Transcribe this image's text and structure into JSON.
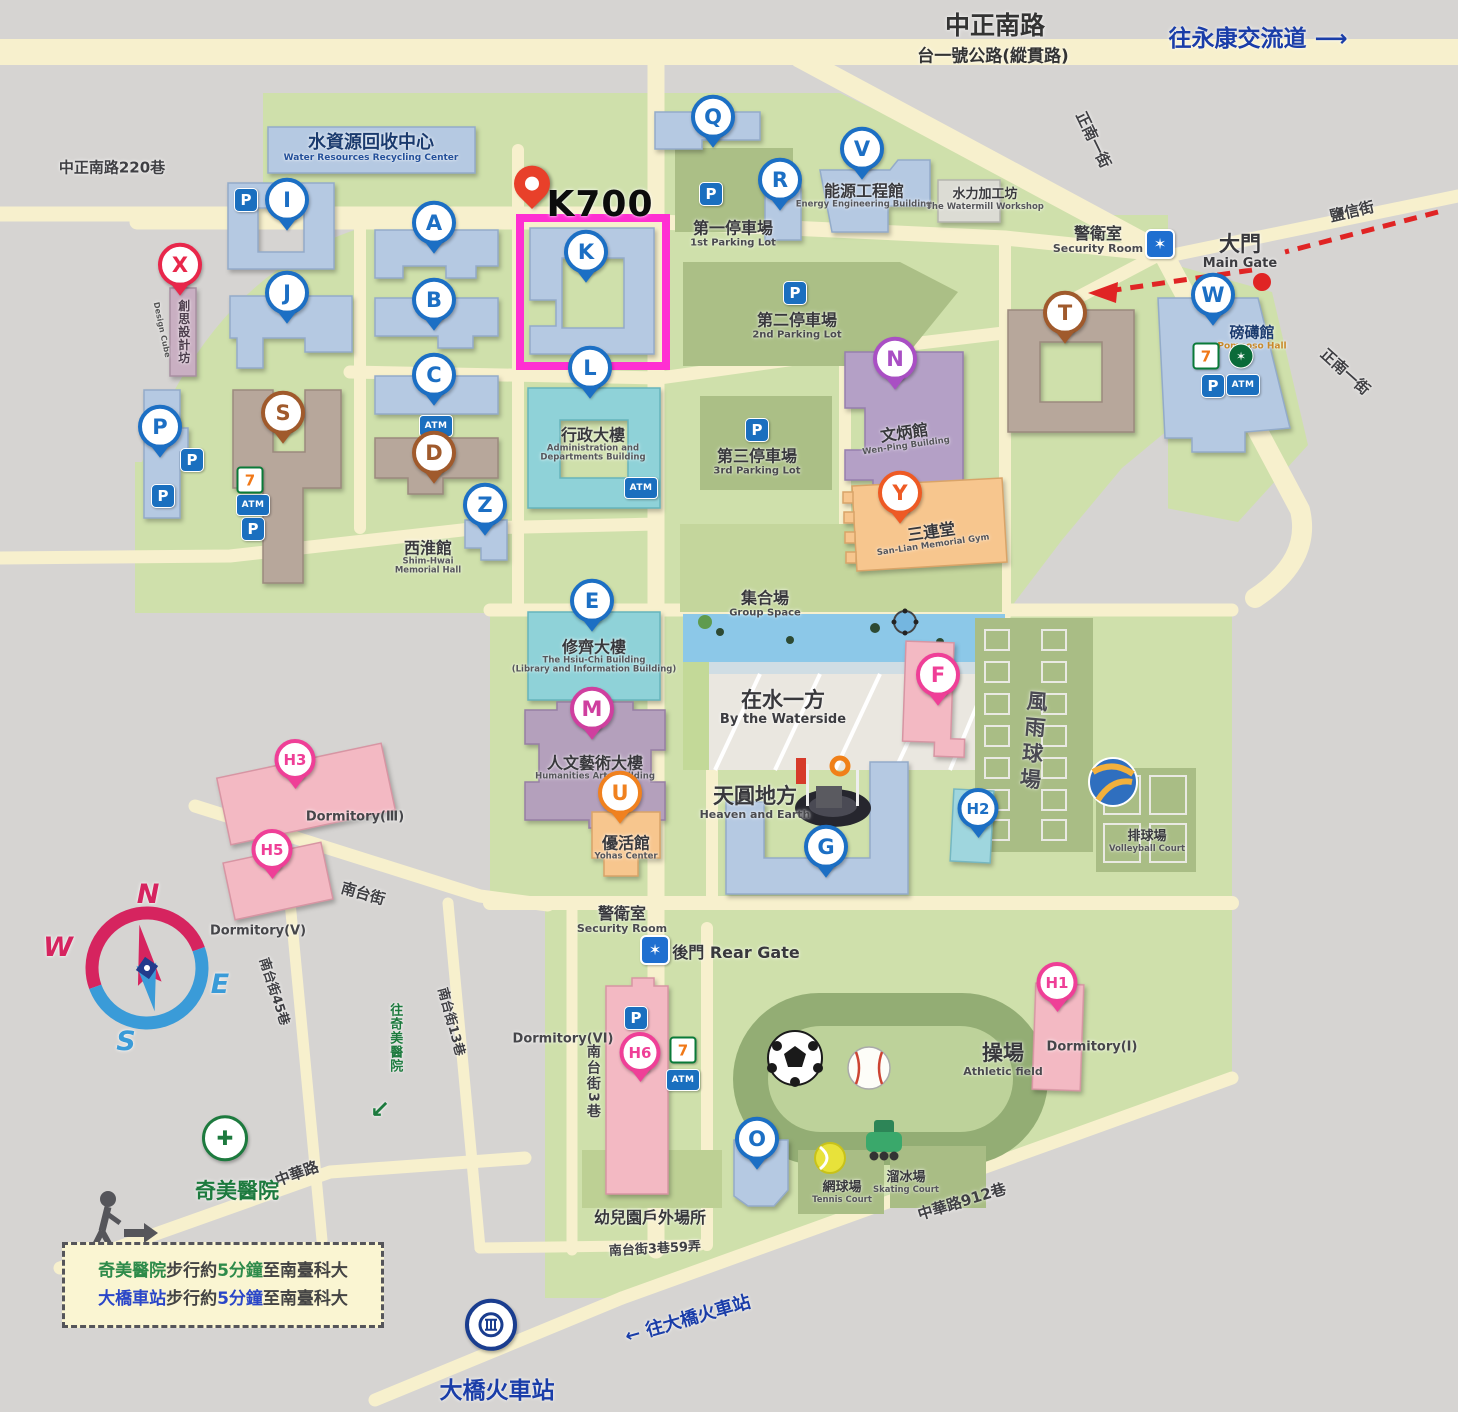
{
  "title": "STUST campus map",
  "highlight": {
    "label": "K700",
    "pin": {
      "x": 532,
      "y": 198
    },
    "box": {
      "x": 520,
      "y": 218,
      "w": 146,
      "h": 148
    },
    "box_color": "#ff2fd2"
  },
  "palette": {
    "blue": "#1c6fc4",
    "red": "#e8274b",
    "pink": "#ef3f97",
    "magenta": "#cf3f9f",
    "orange": "#f0811f",
    "orangered": "#ee5a24",
    "brown": "#a05a2c",
    "purple": "#a94fc4",
    "green": "#1d7a3e",
    "navy": "#1a3d8f",
    "campus_green": "#cfe0ab",
    "road": "#f7f0cd",
    "bg_gray": "#d6d4d2",
    "bldg_blue": "#b5c9e2",
    "bldg_teal": "#8fd2d8",
    "bldg_brown": "#b7a79b",
    "bldg_purple": "#b4a0c6",
    "bldg_orange": "#f7c68e",
    "bldg_pink": "#f3b9c3",
    "bldg_cyan": "#9fd6de",
    "parking_olive": "#abbf86"
  },
  "compass": {
    "n": "N",
    "w": "W",
    "e": "E",
    "s": "S"
  },
  "pins": [
    {
      "id": "pin-Q",
      "letter": "Q",
      "c": "blue",
      "x": 713,
      "y": 120
    },
    {
      "id": "pin-V",
      "letter": "V",
      "c": "blue",
      "x": 862,
      "y": 152
    },
    {
      "id": "pin-R",
      "letter": "R",
      "c": "blue",
      "x": 780,
      "y": 183
    },
    {
      "id": "pin-I",
      "letter": "I",
      "c": "blue",
      "x": 287,
      "y": 203
    },
    {
      "id": "pin-A",
      "letter": "A",
      "c": "blue",
      "x": 434,
      "y": 226
    },
    {
      "id": "pin-K",
      "letter": "K",
      "c": "blue",
      "x": 586,
      "y": 255
    },
    {
      "id": "pin-J",
      "letter": "J",
      "c": "blue",
      "x": 287,
      "y": 296
    },
    {
      "id": "pin-B",
      "letter": "B",
      "c": "blue",
      "x": 434,
      "y": 303
    },
    {
      "id": "pin-C",
      "letter": "C",
      "c": "blue",
      "x": 434,
      "y": 378
    },
    {
      "id": "pin-L",
      "letter": "L",
      "c": "blue",
      "x": 590,
      "y": 371
    },
    {
      "id": "pin-Z",
      "letter": "Z",
      "c": "blue",
      "x": 485,
      "y": 508
    },
    {
      "id": "pin-E",
      "letter": "E",
      "c": "blue",
      "x": 592,
      "y": 604
    },
    {
      "id": "pin-G",
      "letter": "G",
      "c": "blue",
      "x": 826,
      "y": 850
    },
    {
      "id": "pin-O",
      "letter": "O",
      "c": "blue",
      "x": 757,
      "y": 1142
    },
    {
      "id": "pin-W",
      "letter": "W",
      "c": "blue",
      "x": 1213,
      "y": 298
    },
    {
      "id": "pin-P-lot",
      "letter": "P",
      "c": "blue",
      "x": 160,
      "y": 430
    },
    {
      "id": "pin-H2",
      "letter": "H2",
      "c": "blue",
      "x": 978,
      "y": 812
    },
    {
      "id": "pin-X",
      "letter": "X",
      "c": "red",
      "x": 180,
      "y": 268
    },
    {
      "id": "pin-S",
      "letter": "S",
      "c": "brown",
      "x": 283,
      "y": 416
    },
    {
      "id": "pin-D",
      "letter": "D",
      "c": "brown",
      "x": 434,
      "y": 456
    },
    {
      "id": "pin-T",
      "letter": "T",
      "c": "brown",
      "x": 1065,
      "y": 316
    },
    {
      "id": "pin-N",
      "letter": "N",
      "c": "purple",
      "x": 895,
      "y": 362
    },
    {
      "id": "pin-Y",
      "letter": "Y",
      "c": "orangered",
      "x": 900,
      "y": 496
    },
    {
      "id": "pin-U",
      "letter": "U",
      "c": "orange",
      "x": 620,
      "y": 796
    },
    {
      "id": "pin-M",
      "letter": "M",
      "c": "magenta",
      "x": 592,
      "y": 712
    },
    {
      "id": "pin-F",
      "letter": "F",
      "c": "pink",
      "x": 938,
      "y": 678
    },
    {
      "id": "pin-H3",
      "letter": "H3",
      "c": "pink",
      "x": 295,
      "y": 763
    },
    {
      "id": "pin-H5",
      "letter": "H5",
      "c": "pink",
      "x": 272,
      "y": 853
    },
    {
      "id": "pin-H6",
      "letter": "H6",
      "c": "pink",
      "x": 640,
      "y": 1056
    },
    {
      "id": "pin-H1",
      "letter": "H1",
      "c": "pink",
      "x": 1057,
      "y": 986
    }
  ],
  "special_pins": {
    "hospital": {
      "id": "chimei-hospital-pin",
      "x": 225,
      "y": 1136,
      "glyph": "✚"
    },
    "train": {
      "id": "daqiao-station-pin",
      "x": 491,
      "y": 1322
    }
  },
  "badges": [
    {
      "t": "p",
      "x": 246,
      "y": 200
    },
    {
      "t": "p",
      "x": 711,
      "y": 194
    },
    {
      "t": "p",
      "x": 795,
      "y": 293
    },
    {
      "t": "p",
      "x": 757,
      "y": 430
    },
    {
      "t": "p",
      "x": 192,
      "y": 460
    },
    {
      "t": "p",
      "x": 163,
      "y": 496
    },
    {
      "t": "p",
      "x": 253,
      "y": 529
    },
    {
      "t": "p",
      "x": 636,
      "y": 1018
    },
    {
      "t": "p",
      "x": 1213,
      "y": 386
    },
    {
      "t": "atm",
      "x": 436,
      "y": 426
    },
    {
      "t": "atm",
      "x": 253,
      "y": 505
    },
    {
      "t": "atm",
      "x": 641,
      "y": 488
    },
    {
      "t": "atm",
      "x": 1243,
      "y": 385
    },
    {
      "t": "atm",
      "x": 683,
      "y": 1080
    },
    {
      "t": "seven",
      "x": 250,
      "y": 480
    },
    {
      "t": "seven",
      "x": 1206,
      "y": 356
    },
    {
      "t": "seven",
      "x": 683,
      "y": 1050
    },
    {
      "t": "sb",
      "x": 1241,
      "y": 356
    },
    {
      "t": "police",
      "x": 1160,
      "y": 244
    },
    {
      "t": "police",
      "x": 655,
      "y": 950
    }
  ],
  "labels": [
    {
      "id": "road-zhongzheng-south",
      "x": 995,
      "y": 26,
      "lines": [
        {
          "t": "中正南路",
          "c": "rd-lg"
        }
      ]
    },
    {
      "id": "road-tai1-highway",
      "x": 993,
      "y": 57,
      "lines": [
        {
          "t": "台一號公路(縱貫路)",
          "c": "rd-md"
        }
      ]
    },
    {
      "id": "to-yongkang-interchange",
      "x": 1258,
      "y": 40,
      "lines": [
        {
          "t": "往永康交流道 ⟶",
          "c": "blue-lg"
        }
      ]
    },
    {
      "id": "road-lane220",
      "x": 112,
      "y": 168,
      "lines": [
        {
          "t": "中正南路220巷",
          "c": "rd-sm"
        }
      ]
    },
    {
      "id": "road-zhengnan1-top",
      "x": 1093,
      "y": 140,
      "rot": 64,
      "lines": [
        {
          "t": "正南一街",
          "c": "rd-sm"
        }
      ]
    },
    {
      "id": "road-yanxin-st",
      "x": 1352,
      "y": 212,
      "rot": -13,
      "lines": [
        {
          "t": "鹽信街",
          "c": "rd-sm"
        }
      ]
    },
    {
      "id": "road-zhengnan1-right",
      "x": 1345,
      "y": 372,
      "rot": 42,
      "lines": [
        {
          "t": "正南一街",
          "c": "rd-sm"
        }
      ]
    },
    {
      "id": "water-recycle-center",
      "x": 371,
      "y": 148,
      "lines": [
        {
          "t": "水資源回收中心",
          "c": "navy-md"
        },
        {
          "t": "Water Resources Recycling Center",
          "c": "navy-en"
        }
      ]
    },
    {
      "id": "parking-lot-1",
      "x": 733,
      "y": 234,
      "lines": [
        {
          "t": "第一停車場",
          "c": "zh-md"
        },
        {
          "t": "1st Parking Lot",
          "c": "en-xs"
        }
      ]
    },
    {
      "id": "energy-engineering-bldg",
      "x": 864,
      "y": 196,
      "lines": [
        {
          "t": "能源工程館",
          "c": "zh-md"
        },
        {
          "t": "Energy Engineering Building",
          "c": "en-xxs"
        }
      ]
    },
    {
      "id": "watermill-workshop",
      "x": 985,
      "y": 200,
      "lines": [
        {
          "t": "水力加工坊",
          "c": "zh-sm"
        },
        {
          "t": "The Watermill Workshop",
          "c": "en-xxs"
        }
      ]
    },
    {
      "id": "security-room-main",
      "x": 1098,
      "y": 240,
      "lines": [
        {
          "t": "警衛室",
          "c": "zh-md"
        },
        {
          "t": "Security Room",
          "c": "en-sm"
        }
      ]
    },
    {
      "id": "main-gate",
      "x": 1240,
      "y": 252,
      "lines": [
        {
          "t": "大門",
          "c": "zh-lg"
        },
        {
          "t": "Main Gate",
          "c": "en-md"
        }
      ]
    },
    {
      "id": "pomposo-hall",
      "x": 1252,
      "y": 338,
      "lines": [
        {
          "t": "磅礡館",
          "c": "navy-sm"
        },
        {
          "t": "Pomposo Hall",
          "c": "or-en"
        }
      ]
    },
    {
      "id": "parking-lot-2",
      "x": 797,
      "y": 326,
      "lines": [
        {
          "t": "第二停車場",
          "c": "zh-md"
        },
        {
          "t": "2nd Parking Lot",
          "c": "en-xs"
        }
      ]
    },
    {
      "id": "parking-lot-3",
      "x": 757,
      "y": 462,
      "lines": [
        {
          "t": "第三停車場",
          "c": "zh-md"
        },
        {
          "t": "3rd Parking Lot",
          "c": "en-xs"
        }
      ]
    },
    {
      "id": "admin-bldg",
      "x": 593,
      "y": 445,
      "lines": [
        {
          "t": "行政大樓",
          "c": "zh-md"
        },
        {
          "t": "Administration and",
          "c": "en-xxs"
        },
        {
          "t": "Departments Building",
          "c": "en-xxs"
        }
      ]
    },
    {
      "id": "wenping-bldg",
      "x": 905,
      "y": 438,
      "rot": -8,
      "lines": [
        {
          "t": "文炳館",
          "c": "zh-md"
        },
        {
          "t": "Wen-Ping Building",
          "c": "en-xxs"
        }
      ]
    },
    {
      "id": "sanlian-gym",
      "x": 932,
      "y": 537,
      "rot": -8,
      "lines": [
        {
          "t": "三連堂",
          "c": "zh-md"
        },
        {
          "t": "San-Lian Memorial Gym",
          "c": "en-xxs"
        }
      ]
    },
    {
      "id": "shimhwai-hall",
      "x": 428,
      "y": 558,
      "lines": [
        {
          "t": "西淮館",
          "c": "zh-md"
        },
        {
          "t": "Shim-Hwai",
          "c": "en-xxs"
        },
        {
          "t": "Memorial Hall",
          "c": "en-xxs"
        }
      ]
    },
    {
      "id": "group-space",
      "x": 765,
      "y": 604,
      "lines": [
        {
          "t": "集合場",
          "c": "zh-md"
        },
        {
          "t": "Group Space",
          "c": "en-xs"
        }
      ]
    },
    {
      "id": "by-the-waterside",
      "x": 783,
      "y": 708,
      "lines": [
        {
          "t": "在水一方",
          "c": "zh-lg"
        },
        {
          "t": "By the Waterside",
          "c": "en-md"
        }
      ]
    },
    {
      "id": "hsiuchi-bldg",
      "x": 594,
      "y": 657,
      "lines": [
        {
          "t": "修齊大樓",
          "c": "zh-md"
        },
        {
          "t": "The Hsiu-Chi Building",
          "c": "en-xxs"
        },
        {
          "t": "(Library and Information Building)",
          "c": "en-xxs"
        }
      ]
    },
    {
      "id": "humanities-arts-bldg",
      "x": 595,
      "y": 768,
      "lines": [
        {
          "t": "人文藝術大樓",
          "c": "zh-md"
        },
        {
          "t": "Humanities Arts Building",
          "c": "en-xxs"
        }
      ]
    },
    {
      "id": "yohas-center",
      "x": 626,
      "y": 848,
      "lines": [
        {
          "t": "優活館",
          "c": "zh-md"
        },
        {
          "t": "Yohas Center",
          "c": "en-xxs"
        }
      ]
    },
    {
      "id": "heaven-and-earth",
      "x": 755,
      "y": 803,
      "lines": [
        {
          "t": "天圓地方",
          "c": "zh-lg"
        },
        {
          "t": "Heaven and Earth",
          "c": "en-sm"
        }
      ]
    },
    {
      "id": "wind-rain-courts",
      "x": 1032,
      "y": 742,
      "rot": 5,
      "lines": [
        {
          "t": "風雨球場",
          "c": "zh-vert"
        }
      ]
    },
    {
      "id": "volleyball-court",
      "x": 1147,
      "y": 842,
      "lines": [
        {
          "t": "排球場",
          "c": "zh-sm"
        },
        {
          "t": "Volleyball Court",
          "c": "en-xxs"
        }
      ]
    },
    {
      "id": "dormitory-3",
      "x": 355,
      "y": 818,
      "lines": [
        {
          "t": "Dormitory(Ⅲ)",
          "c": "en-dorm"
        }
      ]
    },
    {
      "id": "dormitory-5",
      "x": 258,
      "y": 932,
      "lines": [
        {
          "t": "Dormitory(V)",
          "c": "en-dorm"
        }
      ]
    },
    {
      "id": "security-room-rear",
      "x": 622,
      "y": 920,
      "lines": [
        {
          "t": "警衛室",
          "c": "zh-md"
        },
        {
          "t": "Security Room",
          "c": "en-sm"
        }
      ]
    },
    {
      "id": "rear-gate",
      "x": 736,
      "y": 953,
      "lines": [
        {
          "t": "後門 Rear Gate",
          "c": "zh-md"
        }
      ]
    },
    {
      "id": "dormitory-6",
      "x": 563,
      "y": 1040,
      "lines": [
        {
          "t": "Dormitory(VI)",
          "c": "en-dorm"
        }
      ]
    },
    {
      "id": "athletic-field",
      "x": 1003,
      "y": 1060,
      "lines": [
        {
          "t": "操場",
          "c": "zh-lg"
        },
        {
          "t": "Athletic field",
          "c": "en-sm"
        }
      ]
    },
    {
      "id": "tennis-court",
      "x": 842,
      "y": 1193,
      "lines": [
        {
          "t": "網球場",
          "c": "zh-sm"
        },
        {
          "t": "Tennis Court",
          "c": "en-xxs"
        }
      ]
    },
    {
      "id": "skating-court",
      "x": 906,
      "y": 1183,
      "lines": [
        {
          "t": "溜冰場",
          "c": "zh-sm"
        },
        {
          "t": "Skating Court",
          "c": "en-xxs"
        }
      ]
    },
    {
      "id": "dormitory-1",
      "x": 1092,
      "y": 1048,
      "lines": [
        {
          "t": "Dormitory(Ⅰ)",
          "c": "en-dorm"
        }
      ]
    },
    {
      "id": "kindergarten-outdoor",
      "x": 650,
      "y": 1218,
      "lines": [
        {
          "t": "幼兒園戶外場所",
          "c": "zh-md"
        }
      ]
    },
    {
      "id": "road-zhonghua-912",
      "x": 962,
      "y": 1202,
      "rot": -17,
      "lines": [
        {
          "t": "中華路912巷",
          "c": "rd-sm"
        }
      ]
    },
    {
      "id": "road-nantai-st",
      "x": 363,
      "y": 894,
      "rot": 16,
      "lines": [
        {
          "t": "南台街",
          "c": "rd-sm"
        }
      ]
    },
    {
      "id": "road-nantai-45",
      "x": 273,
      "y": 992,
      "rot": 72,
      "lines": [
        {
          "t": "南台街45巷",
          "c": "rd-xs"
        }
      ]
    },
    {
      "id": "road-nantai-13",
      "x": 450,
      "y": 1022,
      "rot": 75,
      "lines": [
        {
          "t": "南台街13巷",
          "c": "rd-xs"
        }
      ]
    },
    {
      "id": "to-chimei-hospital",
      "x": 394,
      "y": 1038,
      "lines": [
        {
          "t": "往奇美醫院",
          "c": "grn-vert"
        }
      ]
    },
    {
      "id": "to-chimei-arrow",
      "x": 380,
      "y": 1110,
      "lines": [
        {
          "t": "↙",
          "c": "grn-arrow"
        }
      ]
    },
    {
      "id": "road-zhonghua",
      "x": 297,
      "y": 1174,
      "rot": -20,
      "lines": [
        {
          "t": "中華路",
          "c": "rd-sm"
        }
      ]
    },
    {
      "id": "chimei-hospital",
      "x": 237,
      "y": 1192,
      "lines": [
        {
          "t": "奇美醫院",
          "c": "grn-lg"
        }
      ]
    },
    {
      "id": "road-nantai-3",
      "x": 592,
      "y": 1082,
      "lines": [
        {
          "t": "南台街3巷",
          "c": "rd-vert"
        }
      ]
    },
    {
      "id": "road-nantai-3-59",
      "x": 655,
      "y": 1250,
      "rot": -3,
      "lines": [
        {
          "t": "南台街3巷59弄",
          "c": "rd-xs"
        }
      ]
    },
    {
      "id": "to-daqiao-station",
      "x": 688,
      "y": 1320,
      "rot": -16,
      "lines": [
        {
          "t": "← 往大橋火車站",
          "c": "blue-md"
        }
      ]
    },
    {
      "id": "daqiao-train-station",
      "x": 497,
      "y": 1392,
      "lines": [
        {
          "t": "大橋火車站",
          "c": "blue-lg"
        }
      ]
    },
    {
      "id": "k700-callout",
      "x": 600,
      "y": 205,
      "lines": [
        {
          "t": "K700",
          "c": "k700"
        }
      ]
    },
    {
      "id": "design-cube-zh",
      "x": 183,
      "y": 332,
      "lines": [
        {
          "t": "創思設計坊",
          "c": "zh-vert-sm"
        }
      ]
    },
    {
      "id": "design-cube-en",
      "x": 161,
      "y": 330,
      "rot": 78,
      "lines": [
        {
          "t": "Design Cube",
          "c": "en-tiny"
        }
      ]
    }
  ],
  "legend": {
    "line1": [
      {
        "t": "奇美醫院",
        "c": "#2e8b4a"
      },
      {
        "t": "步行約",
        "c": "#444"
      },
      {
        "t": "5分鐘",
        "c": "#2e8b4a"
      },
      {
        "t": "至南臺科大",
        "c": "#444"
      }
    ],
    "line2": [
      {
        "t": "大橋車站",
        "c": "#2a46c8"
      },
      {
        "t": "步行約",
        "c": "#444"
      },
      {
        "t": "5分鐘",
        "c": "#2a46c8"
      },
      {
        "t": "至南臺科大",
        "c": "#444"
      }
    ]
  }
}
